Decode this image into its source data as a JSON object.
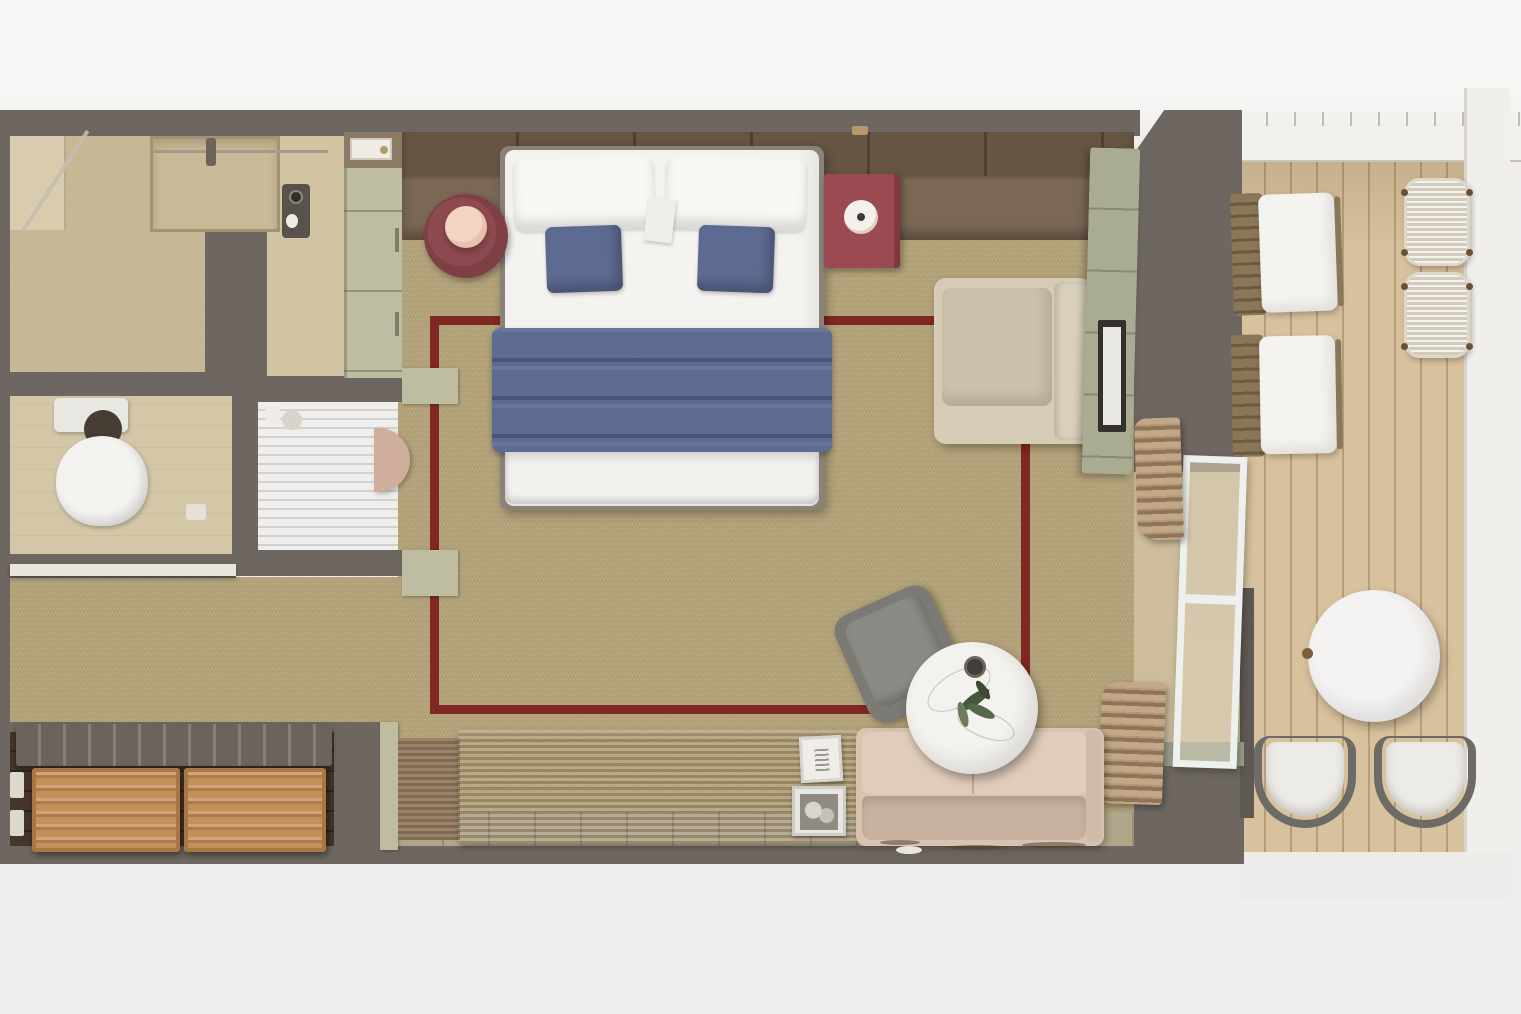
{
  "scene": {
    "description": "Top-down 3D rendering of a suite floor plan with bedroom, bathroom, entry closet, living area and a private wooden-deck balcony",
    "view": "top-down render",
    "text_visible": false
  },
  "palette": {
    "bg": "#efeeec",
    "bg_top": "#f7f7f5",
    "wall": "#6e6761",
    "carpet": "#b3a278",
    "rug_border": "#7c1d1b",
    "wood": "#7a6754",
    "wood_dark": "#6a5845",
    "sage": "#bfbda1",
    "sage_dark": "#a9ab92",
    "tile": "#cfc19f",
    "bath_tile": "#d4c7a8",
    "tile_strip": "#b2a68a",
    "bed_white": "#f4f3f0",
    "pillow_blue": "#5d6b92",
    "blanket_blue": "#5e6c93",
    "maroon": "#7e3f45",
    "maroon2": "#9a4a50",
    "lamp_pink": "#eac0ac",
    "armchair": "#d5cbb6",
    "sofa": "#d8c3b1",
    "gray_chair": "#7b7a75",
    "marble": "#f3f2ef",
    "plant": "#57684a",
    "deck": "#d8c29e",
    "curtain": "#b29879",
    "drawer": "#c3905a",
    "closet_floor": "#45352a",
    "console_wood": "#8b7260",
    "door_frame": "#eef0ed",
    "sill": "#9aa08b",
    "bench": "#6b635c",
    "white": "#f2f1ee",
    "railing": "#f1efeb"
  },
  "labels": {
    "floorplan": "Suite floor plan - photorealistic top-down render",
    "bathroom": "Bathroom with walk-in shower",
    "shower": "Walk-in shower",
    "toilet": "Toilet",
    "vanity": "Vanity nook with dressing table and half-round stool",
    "wardrobe": "Wardrobe cabinets",
    "entry": "Entry hallway",
    "entry_door": "Entry door",
    "closet": "Closet with luggage bench and wooden drawers",
    "bench": "Luggage bench",
    "drawer": "Wooden drawer",
    "bedroom": "Bedroom with beige carpet",
    "bed": "King bed with white linens, blue accent pillows and blue throw blanket",
    "nightstand_round": "Round maroon nightstand with pink lamp",
    "nightstand_square": "Square maroon nightstand with lamp",
    "rug": "Area rug outlined with a dark red border",
    "armchair": "Beige lounge armchair",
    "sideboard": "Sage sideboard with TV",
    "sofa": "Blush sofa",
    "gray_chair": "Gray swivel chair",
    "coffee_table": "Round white marble coffee table with plant",
    "console": "Wooden media console",
    "frames": "Picture frames",
    "curtain": "Gathered curtain",
    "sliding_door": "Open sliding glass balcony door",
    "balcony": "Private balcony with wooden deck",
    "lounger": "Sun lounger with white cushion",
    "wicker_table": "White wicker side table",
    "bistro_table": "Round white balcony table",
    "bistro_chair": "Balcony chair with white cushion",
    "railing": "White balcony railing"
  }
}
